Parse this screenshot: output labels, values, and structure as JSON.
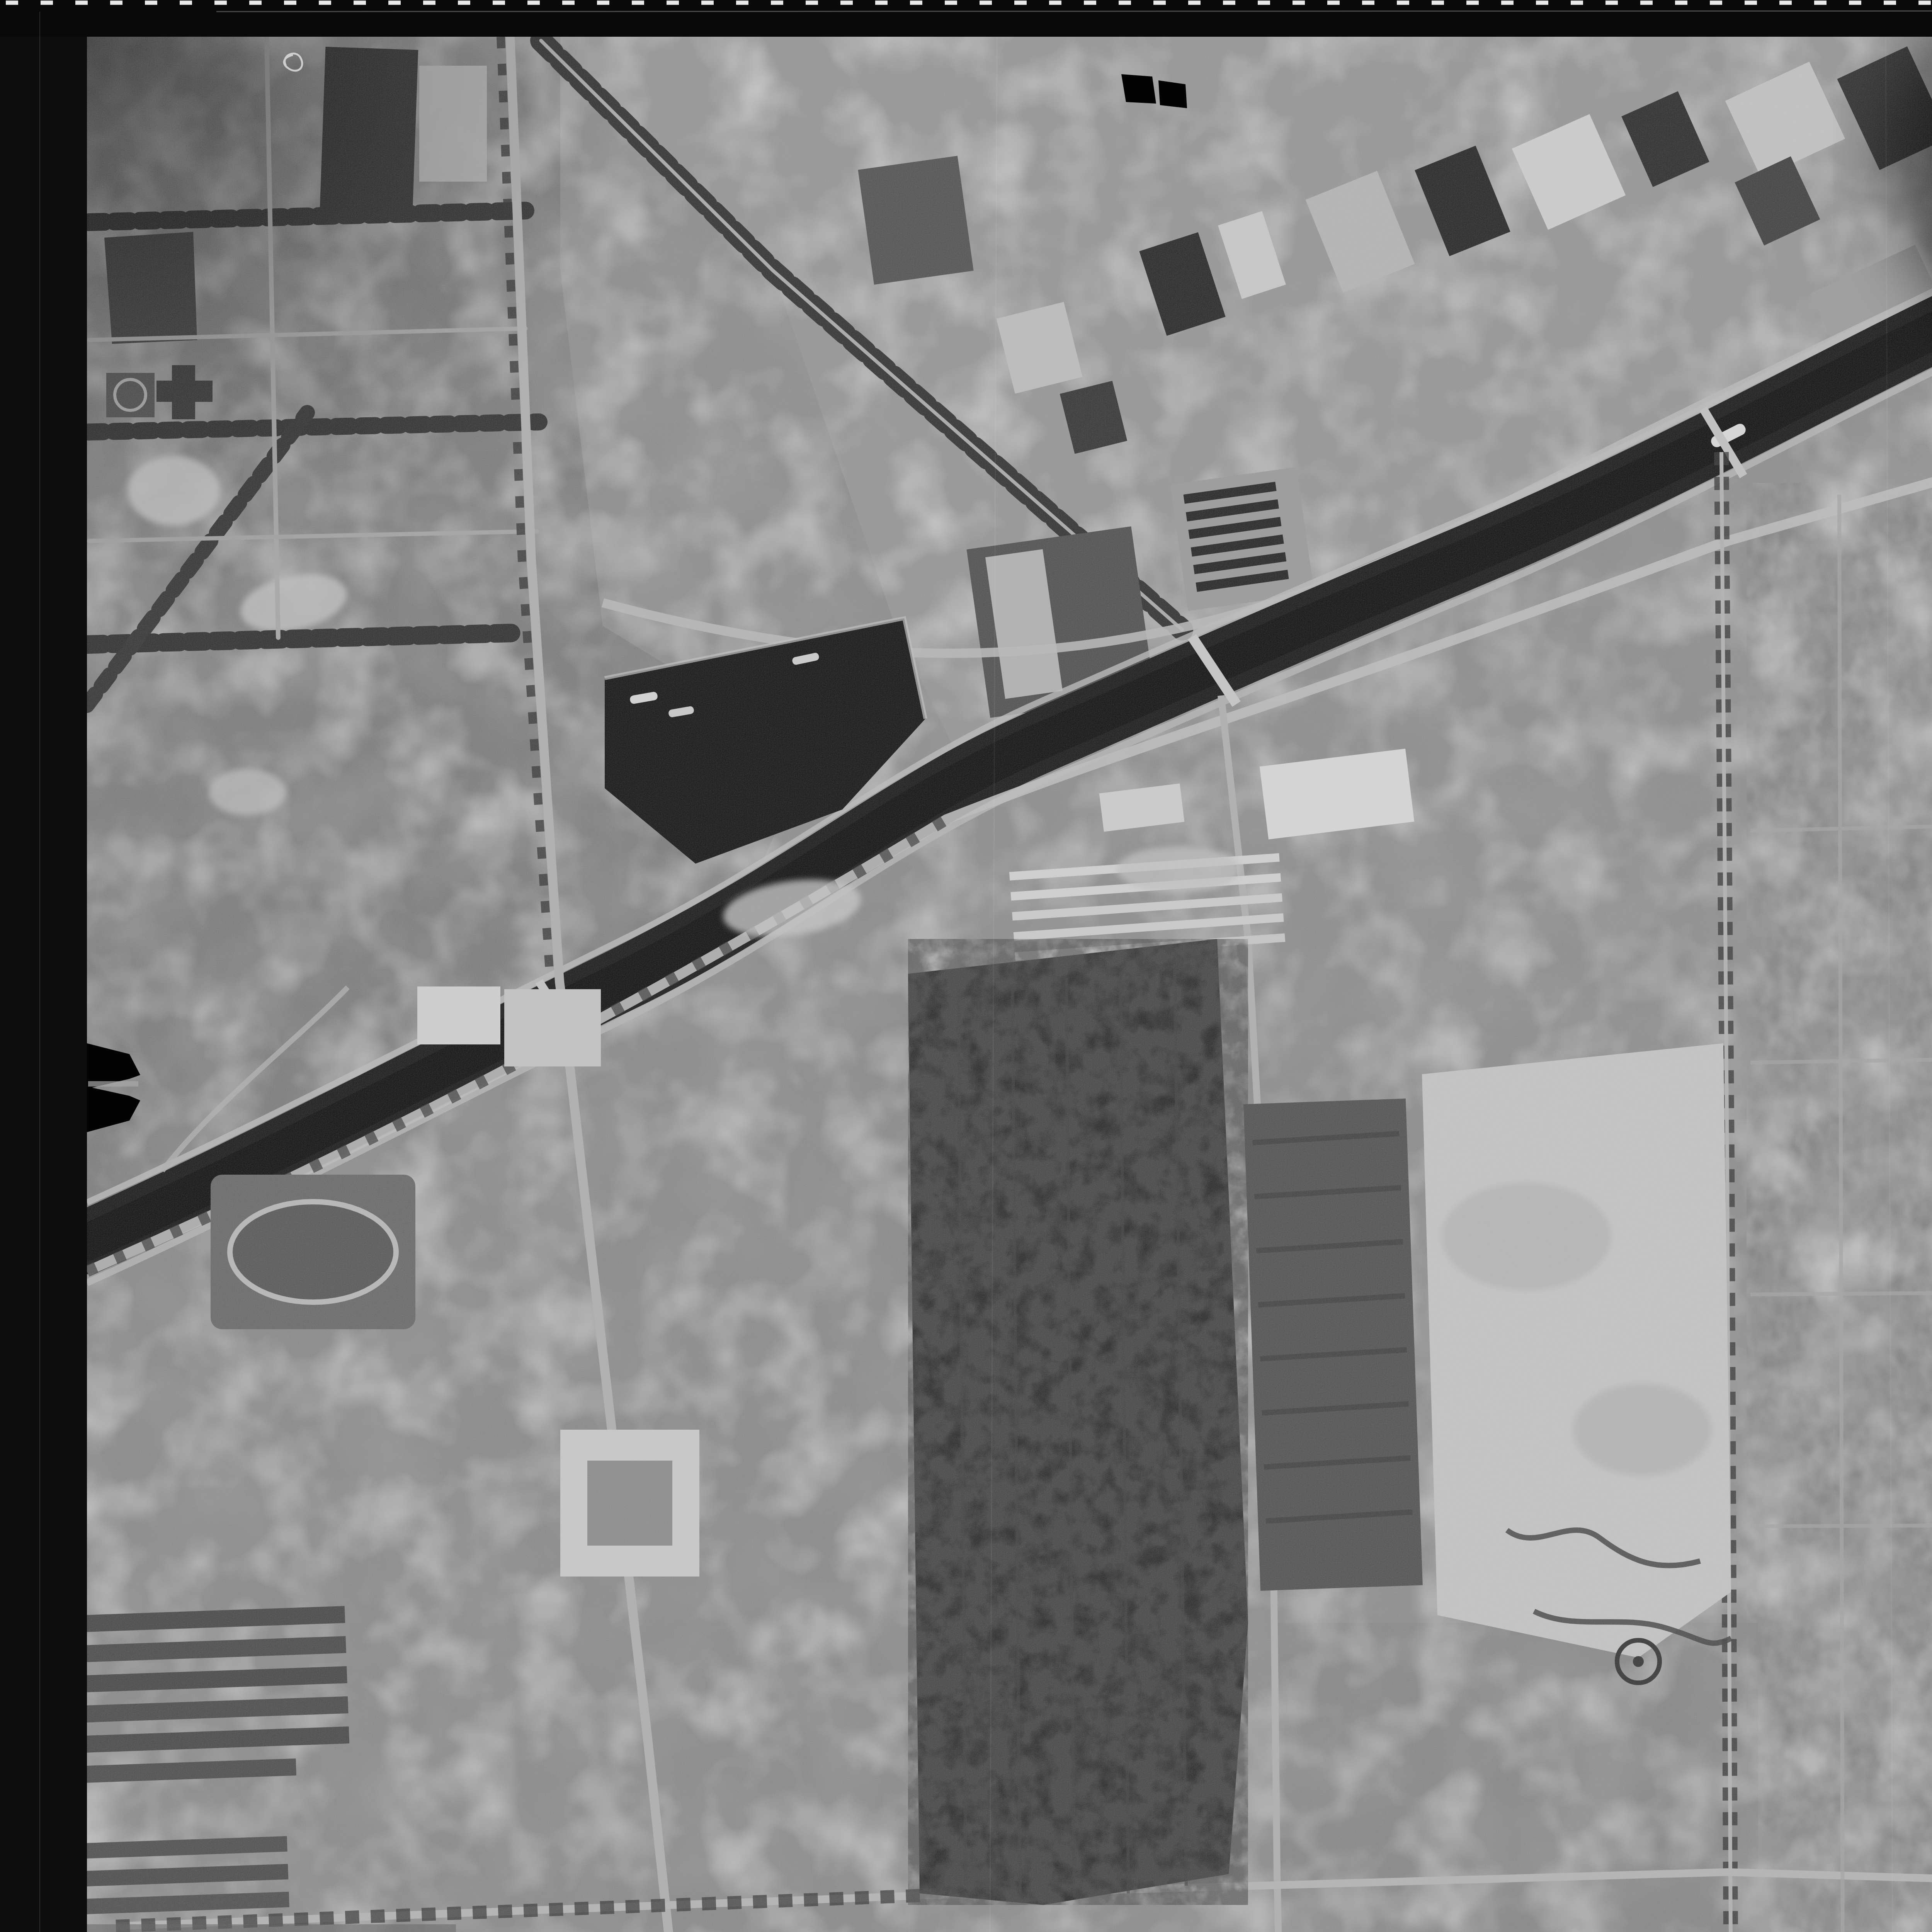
{
  "film": {
    "frame_number": "63/3",
    "edge_text": "KODAK AEROGRAPHIC SAFETY",
    "edge_text_2": "KODAK AEROGRAPHIC SAFETY",
    "edge_number": "905"
  },
  "footer": {
    "site": "pastvu.com/2274991",
    "uploader": "uploaded by nb92",
    "logo": "pastvu-star-logo"
  },
  "photo": {
    "description": "Black-and-white vertical aerial photograph of a city district: a ship canal with harbor basin runs diagonally from upper right to lower left, industrial works line its north bank, dense housing blocks fill the upper left, cemetery woods, sports grounds and allotment gardens fill the south."
  },
  "palette": {
    "film_border": "#0b0b0b",
    "photo_base": "#8f8f8f",
    "water": "#262626",
    "woods": "#333333",
    "flare": "#efefef",
    "marking_white": "#f3f3f3",
    "edge_print_gray": "#6e6e6e",
    "footer_bar": "#4c4c4c",
    "footer_text": "#ebebeb"
  }
}
